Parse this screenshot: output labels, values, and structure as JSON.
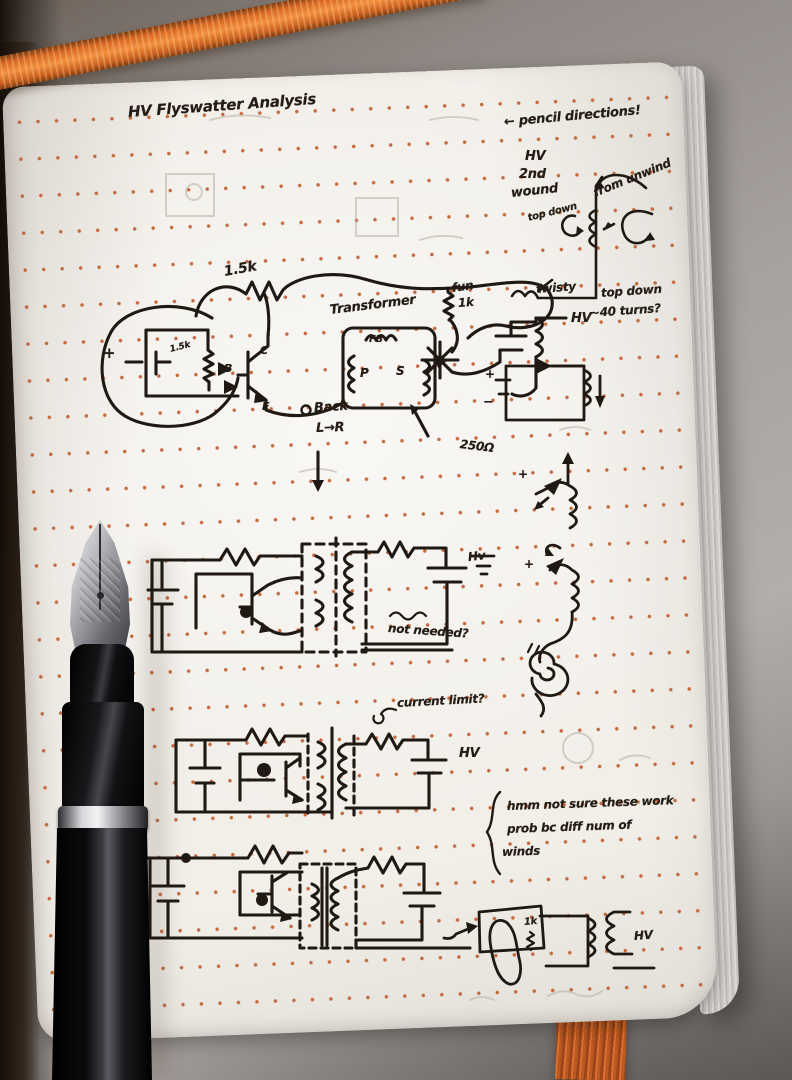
{
  "colors": {
    "ribbon": "#d96722",
    "ink": "#201812",
    "dot_grid": "#c4673c",
    "page": "#f2efe9"
  },
  "title": "HV Flyswatter Analysis",
  "top_right": {
    "pencil_note": "← pencil directions!",
    "hv": "HV",
    "second": "2nd",
    "wound": "wound",
    "top_down_a": "top down",
    "from_unwind": "from unwind",
    "top_down_b": "top down",
    "turns": "~40 turns?",
    "fun": "fun",
    "twisty": "twisty"
  },
  "circuit_top": {
    "r_loop": "1.5k",
    "r_base": "1.5k",
    "battery_plus": "+",
    "b": "B",
    "c": "C",
    "e": "E",
    "transformer": "Transformer",
    "fb": "FB",
    "p": "P",
    "s": "S",
    "r_sec": "1k",
    "hv": "HV",
    "back": "Back",
    "lr": "L→R",
    "ohms": "250Ω",
    "mini_plus": "+",
    "mini_minus": "−"
  },
  "circuit_mid": {
    "hv": "Hv",
    "not_needed": "not needed?"
  },
  "right_sketch": {
    "plus_a": "+",
    "plus_b": "+"
  },
  "circuit_third": {
    "current_limit": "current limit?",
    "hv": "HV"
  },
  "side_note": {
    "line1": "hmm not sure these work",
    "line2": "prob bc diff num of",
    "line3": "winds"
  },
  "bottom_right": {
    "r": "1k",
    "hv": "HV"
  }
}
